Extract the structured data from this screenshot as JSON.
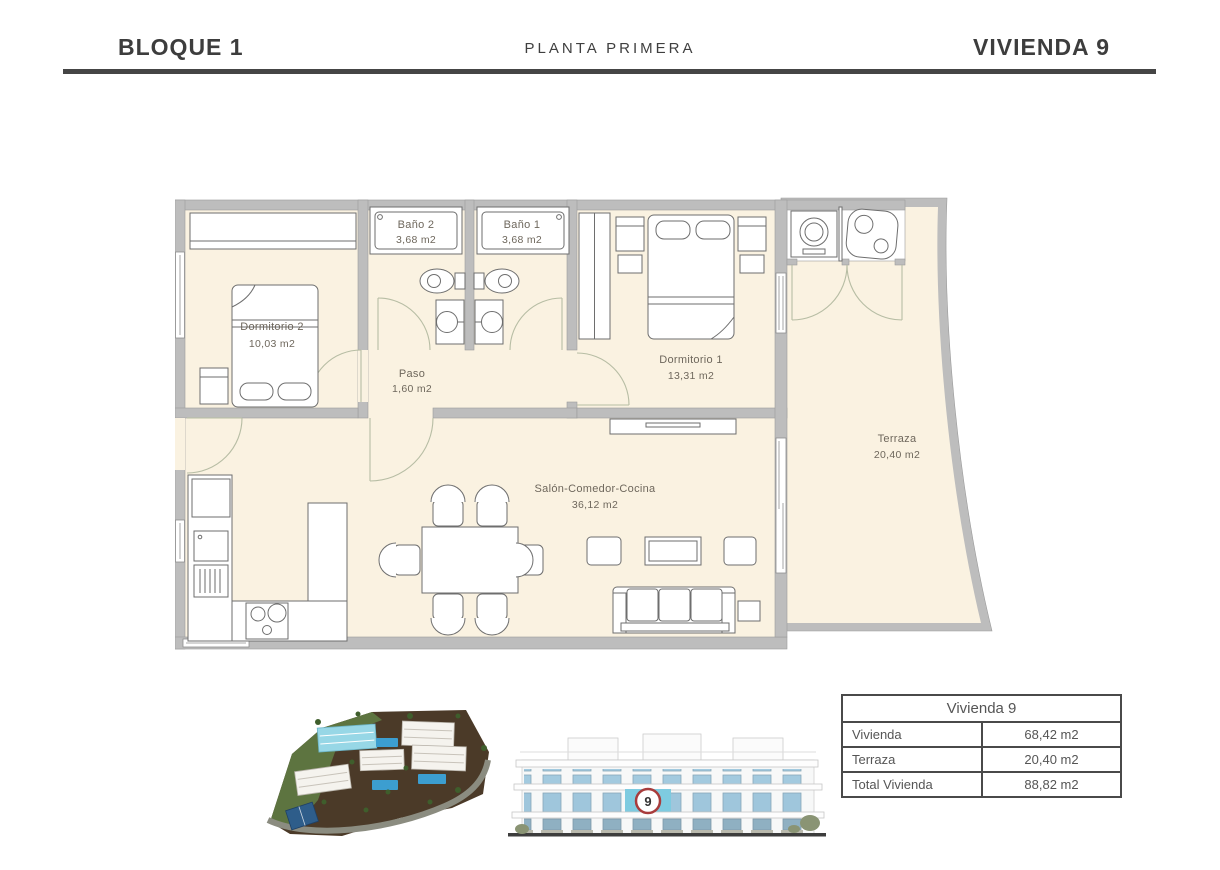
{
  "header": {
    "block": "BLOQUE 1",
    "floor": "PLANTA PRIMERA",
    "unit": "VIVIENDA 9"
  },
  "floor_plan": {
    "rooms": [
      {
        "name": "Dormitorio 2",
        "area": "10,03 m2"
      },
      {
        "name": "Baño 2",
        "area": "3,68 m2"
      },
      {
        "name": "Baño 1",
        "area": "3,68 m2"
      },
      {
        "name": "Paso",
        "area": "1,60 m2"
      },
      {
        "name": "Dormitorio 1",
        "area": "13,31 m2"
      },
      {
        "name": "Salón-Comedor-Cocina",
        "area": "36,12 m2"
      },
      {
        "name": "Terraza",
        "area": "20,40 m2"
      }
    ]
  },
  "summary_table": {
    "title": "Vivienda 9",
    "rows": [
      {
        "label": "Vivienda",
        "value": "68,42 m2"
      },
      {
        "label": "Terraza",
        "value": "20,40 m2"
      },
      {
        "label": "Total Vivienda",
        "value": "88,82 m2"
      }
    ]
  },
  "elevation": {
    "badge": "9"
  },
  "colors": {
    "floor": "#faf2e1",
    "wall": "#bdbdbd",
    "highlight_unit": "#7ecbe0",
    "badge_ring": "#a83c3c",
    "rule": "#454545"
  }
}
